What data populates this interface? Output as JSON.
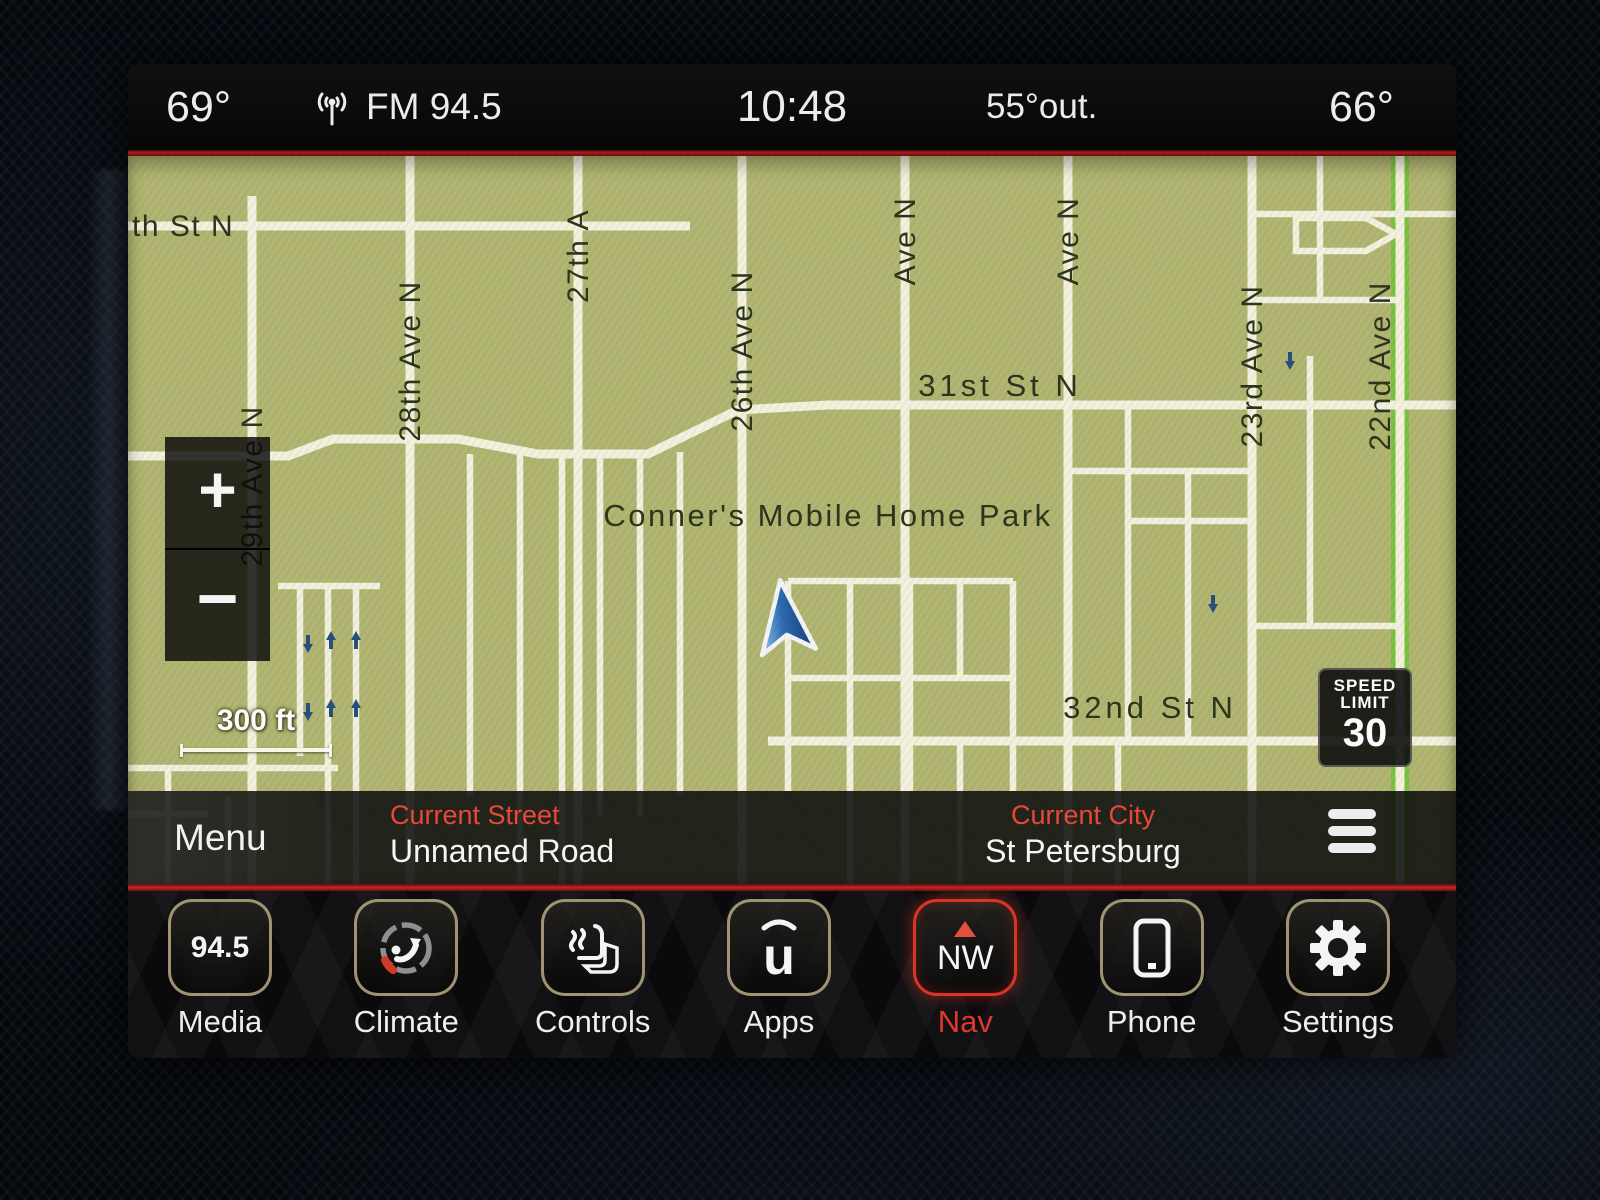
{
  "status_bar": {
    "left_temp": "69°",
    "radio_icon": "radio-signal-icon",
    "station": "FM 94.5",
    "time": "10:48",
    "outside_temp": "55°out.",
    "right_temp": "66°"
  },
  "map": {
    "poi_label": "Conner's Mobile Home Park",
    "street_labels": [
      {
        "text": "th St N"
      },
      {
        "text": "29th Ave N"
      },
      {
        "text": "28th Ave N"
      },
      {
        "text": "27th A"
      },
      {
        "text": "26th Ave N"
      },
      {
        "text": "Ave N"
      },
      {
        "text": "Ave N"
      },
      {
        "text": "23rd Ave N"
      },
      {
        "text": "22nd Ave N"
      },
      {
        "text": "31st St N"
      },
      {
        "text": "32nd St N"
      }
    ],
    "zoom_in_label": "+",
    "zoom_out_label": "−",
    "scale_label": "300 ft",
    "speed_limit": {
      "line1": "SPEED",
      "line2": "LIMIT",
      "value": "30"
    },
    "colors": {
      "background": "#b2b672",
      "road": "#f4f1de",
      "street_label": "#2c361d",
      "route_highlight": "#7dc242",
      "oneway_arrow": "#27517c",
      "vehicle_arrow_dark": "#123f7e",
      "vehicle_arrow_light": "#8ec4ee"
    }
  },
  "info_bar": {
    "menu_label": "Menu",
    "current_street_label": "Current Street",
    "current_street_value": "Unnamed Road",
    "current_city_label": "Current City",
    "current_city_value": "St Petersburg"
  },
  "nav_bar": {
    "items": [
      {
        "id": "media",
        "label": "Media",
        "icon_text": "94.5"
      },
      {
        "id": "climate",
        "label": "Climate"
      },
      {
        "id": "controls",
        "label": "Controls"
      },
      {
        "id": "apps",
        "label": "Apps",
        "icon_text": "u"
      },
      {
        "id": "nav",
        "label": "Nav",
        "icon_text": "NW",
        "active": true
      },
      {
        "id": "phone",
        "label": "Phone"
      },
      {
        "id": "settings",
        "label": "Settings"
      }
    ]
  },
  "colors": {
    "accent_red_line": "#a81f1f",
    "active_nav_red": "#d93425",
    "info_label_red": "#e8473a",
    "status_text": "#ececec"
  }
}
